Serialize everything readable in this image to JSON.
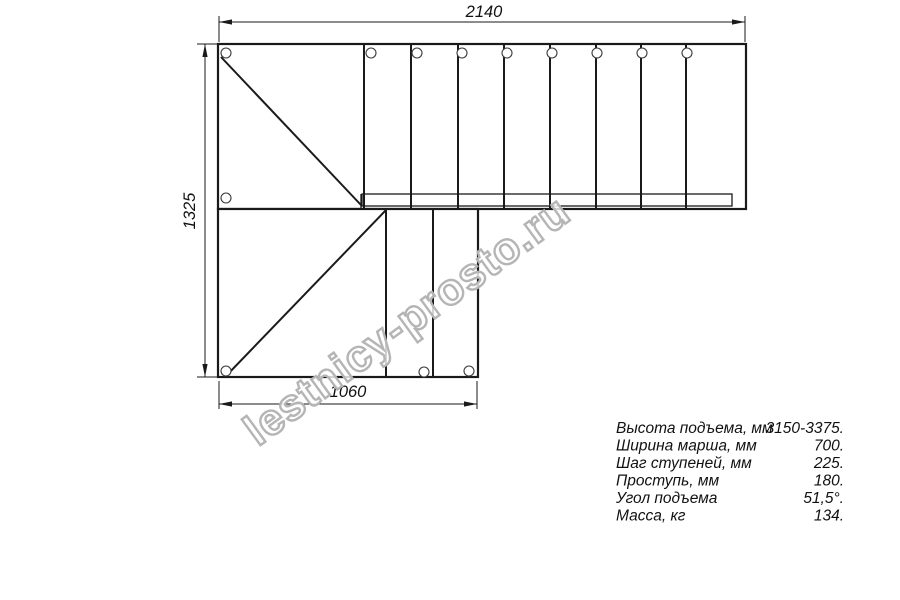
{
  "drawing": {
    "dim_width": "2140",
    "dim_height": "1325",
    "dim_bottom_width": "1060",
    "watermark": "lestnicy-prosto.ru",
    "turn_arrow_icon": "clockwise-turn-arrow",
    "colors": {
      "line": "#1a1a1a",
      "arrow_gray": "#d1d1d1",
      "watermark_gray": "#b5b5b5"
    }
  },
  "specs": {
    "rows": [
      {
        "label": "Высота подъема, мм",
        "value": "3150-3375."
      },
      {
        "label": "Ширина марша, мм",
        "value": "700."
      },
      {
        "label": "Шаг ступеней, мм",
        "value": "225."
      },
      {
        "label": "Проступь, мм",
        "value": "180."
      },
      {
        "label": "Угол подъема",
        "value": "51,5°."
      },
      {
        "label": "Масса, кг",
        "value": "134."
      }
    ]
  }
}
